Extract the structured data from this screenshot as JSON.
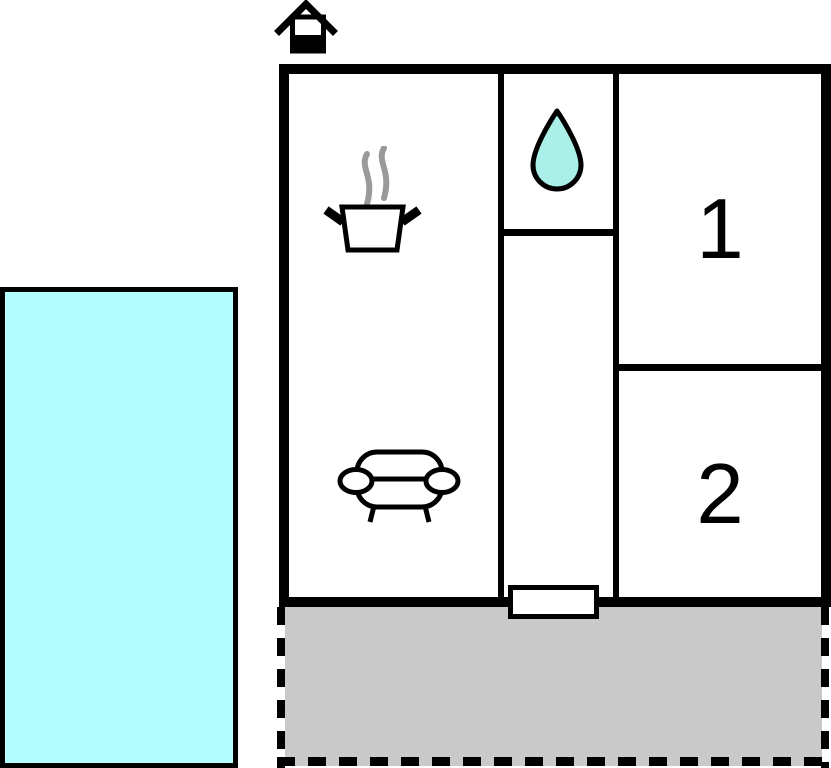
{
  "plan": {
    "bedroom1_label": "1",
    "bedroom2_label": "2",
    "icons": [
      "house-chimney-icon",
      "cooking-pot-icon",
      "water-drop-icon",
      "sofa-icon"
    ]
  },
  "colors": {
    "wall": "#000000",
    "bg": "#ffffff",
    "pool_fill": "#b3ffff",
    "drop_fill": "#abf0e8",
    "terrace_fill": "#c9c9c9",
    "steam": "#9a9a9a"
  }
}
